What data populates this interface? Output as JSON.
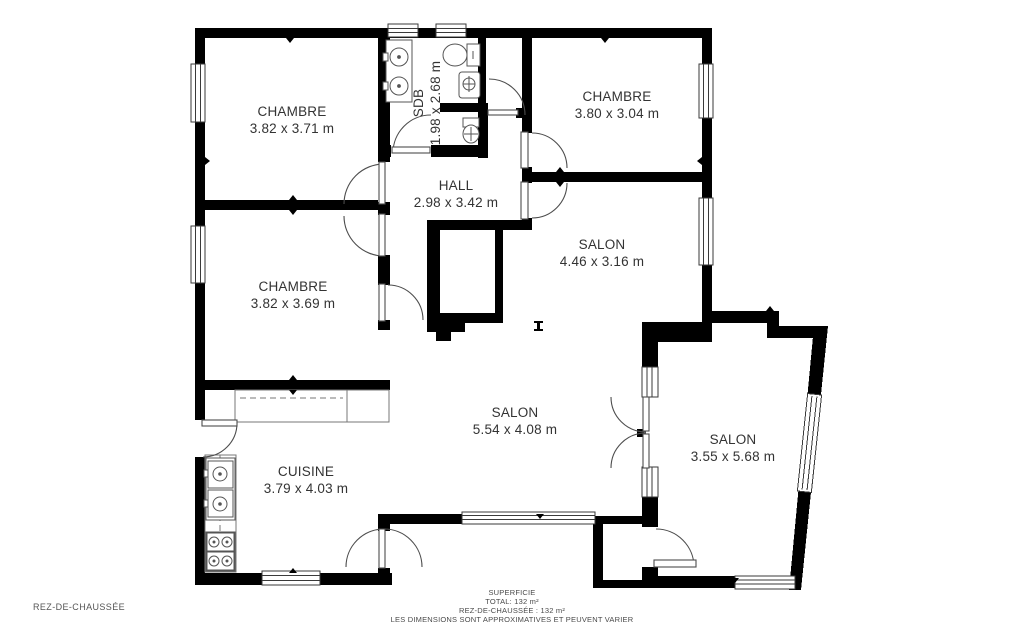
{
  "floor_plan": {
    "floor_label": "REZ-DE-CHAUSSÉE",
    "rooms": [
      {
        "id": "chambre-top-left",
        "name": "CHAMBRE",
        "dims": "3.82 x 3.71 m"
      },
      {
        "id": "sdb",
        "name": "SDB",
        "dims": "1.98 x 2.68 m"
      },
      {
        "id": "chambre-top-right",
        "name": "CHAMBRE",
        "dims": "3.80 x 3.04 m"
      },
      {
        "id": "hall",
        "name": "HALL",
        "dims": "2.98 x 3.42 m"
      },
      {
        "id": "salon-1",
        "name": "SALON",
        "dims": "4.46 x 3.16 m"
      },
      {
        "id": "chambre-mid-left",
        "name": "CHAMBRE",
        "dims": "3.82 x 3.69 m"
      },
      {
        "id": "salon-2",
        "name": "SALON",
        "dims": "5.54 x 4.08 m"
      },
      {
        "id": "cuisine",
        "name": "CUISINE",
        "dims": "3.79 x 4.03 m"
      },
      {
        "id": "salon-3",
        "name": "SALON",
        "dims": "3.55 x 5.68 m"
      }
    ],
    "footer": {
      "superficie_title": "SUPERFICIE",
      "total": "TOTAL: 132 m²",
      "rdc_area": "REZ-DE-CHAUSSÉE : 132 m²",
      "disclaimer": "LES DIMENSIONS SONT APPROXIMATIVES ET PEUVENT VARIER"
    },
    "colors": {
      "wall": "#000000",
      "label_text": "#333333",
      "footer_text": "#4a4a4a",
      "background": "#ffffff",
      "door_swing": "#4d4d4d"
    }
  }
}
